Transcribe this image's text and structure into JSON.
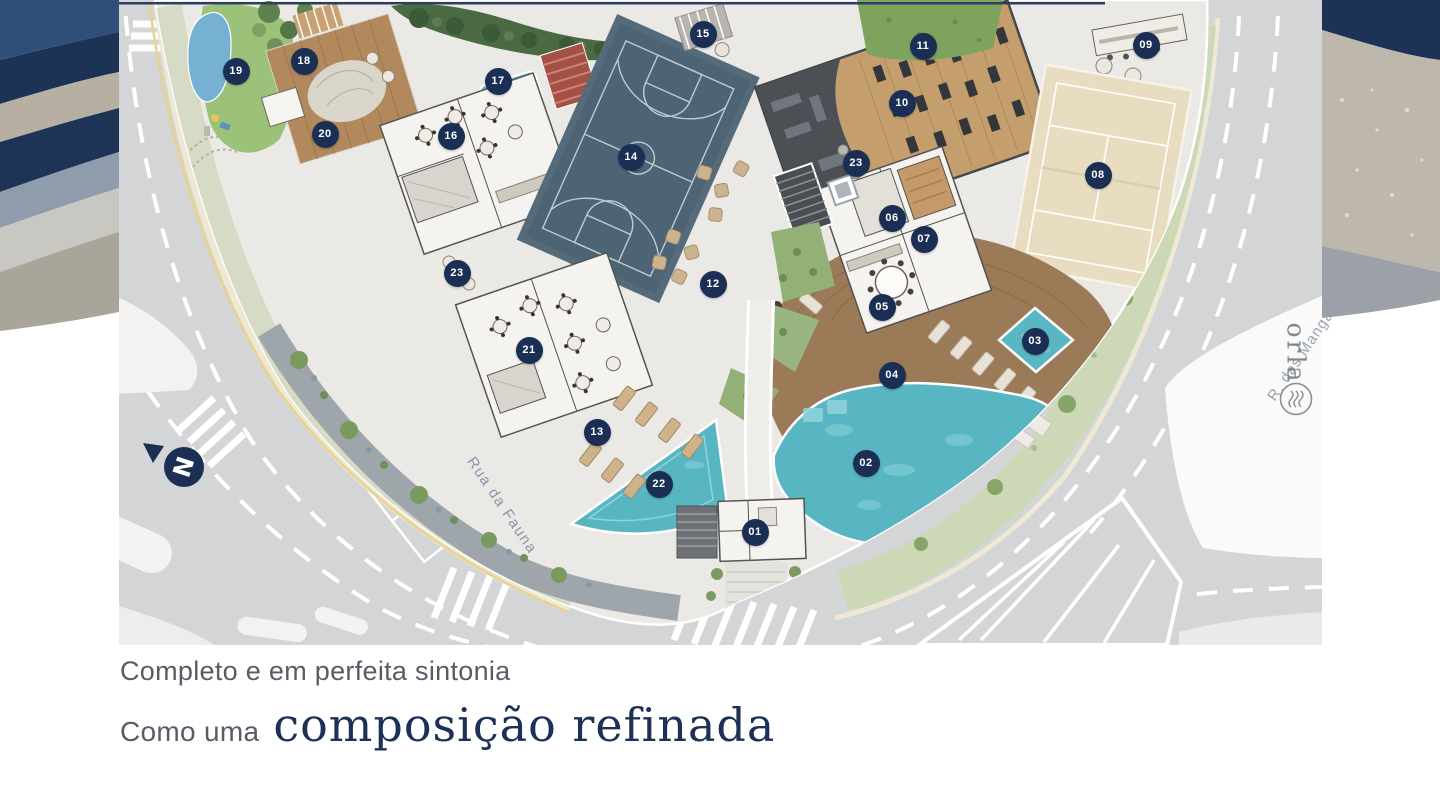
{
  "caption": {
    "line1": "Completo e em perfeita sintonia",
    "line2_prefix": "Como uma",
    "line2_emphasis": "composição refinada"
  },
  "streets": {
    "left": "Rua da Fauna",
    "right": "R. das Mangaloeiras"
  },
  "compass": {
    "label": "N"
  },
  "brand": {
    "logo_text": "orla",
    "logo_icon": "waves-icon"
  },
  "markers": [
    {
      "label": "01",
      "x": 636,
      "y": 532
    },
    {
      "label": "02",
      "x": 747,
      "y": 463
    },
    {
      "label": "03",
      "x": 916,
      "y": 341
    },
    {
      "label": "04",
      "x": 773,
      "y": 375
    },
    {
      "label": "05",
      "x": 763,
      "y": 307
    },
    {
      "label": "06",
      "x": 773,
      "y": 218
    },
    {
      "label": "07",
      "x": 805,
      "y": 239
    },
    {
      "label": "08",
      "x": 979,
      "y": 175
    },
    {
      "label": "09",
      "x": 1027,
      "y": 45
    },
    {
      "label": "10",
      "x": 783,
      "y": 103
    },
    {
      "label": "11",
      "x": 804,
      "y": 46
    },
    {
      "label": "12",
      "x": 594,
      "y": 284
    },
    {
      "label": "13",
      "x": 478,
      "y": 432
    },
    {
      "label": "14",
      "x": 512,
      "y": 157
    },
    {
      "label": "15",
      "x": 584,
      "y": 34
    },
    {
      "label": "16",
      "x": 332,
      "y": 136
    },
    {
      "label": "17",
      "x": 379,
      "y": 81
    },
    {
      "label": "18",
      "x": 185,
      "y": 61
    },
    {
      "label": "19",
      "x": 117,
      "y": 71
    },
    {
      "label": "20",
      "x": 206,
      "y": 134
    },
    {
      "label": "21",
      "x": 410,
      "y": 350
    },
    {
      "label": "22",
      "x": 540,
      "y": 484
    },
    {
      "label": "23",
      "x": 338,
      "y": 273
    },
    {
      "label": "23",
      "x": 737,
      "y": 163
    }
  ],
  "palette": {
    "marker_navy": "#1b2f55",
    "title_navy": "#1d3156",
    "subtitle_gray": "#575d66",
    "road_gray": "#d4d5d7",
    "pool_turquoise": "#58b5c2",
    "wood_deck": "#9b7a57",
    "court_blue": "#4d6474",
    "beach_sand": "#e8ddc1"
  }
}
